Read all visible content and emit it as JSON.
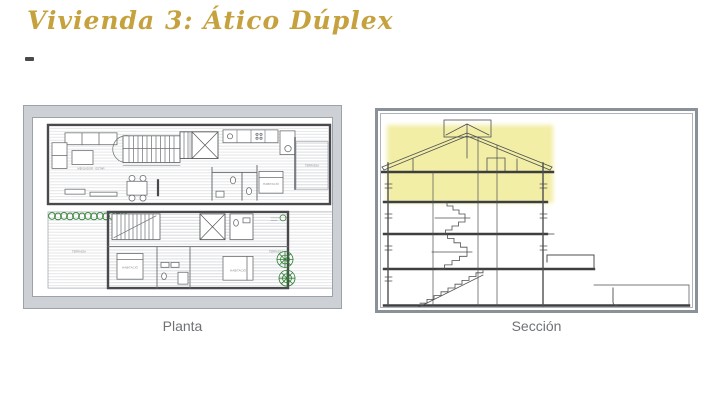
{
  "slide": {
    "title": "Vivienda 3: Ático Dúplex"
  },
  "theme": {
    "title_color": "#C6A23F",
    "caption_color": "#6E7276",
    "frame_gray": "#CDD1D6",
    "section_highlight": "#F3EEA6",
    "vegetation_green": "#2E7D32"
  },
  "planta": {
    "caption": "Planta",
    "labels": {
      "living": "MENJADOR - ESTAR",
      "bedroom_upper": "HABITACIÓ",
      "bedroom_lower_left": "HABITACIÓ",
      "bedroom_lower_right": "HABITACIÓ",
      "terrace_upper": "TERRASSA",
      "terrace_lower_left": "TERRASSA",
      "terrace_lower_right": "TERRASSA"
    }
  },
  "seccion": {
    "caption": "Sección"
  }
}
